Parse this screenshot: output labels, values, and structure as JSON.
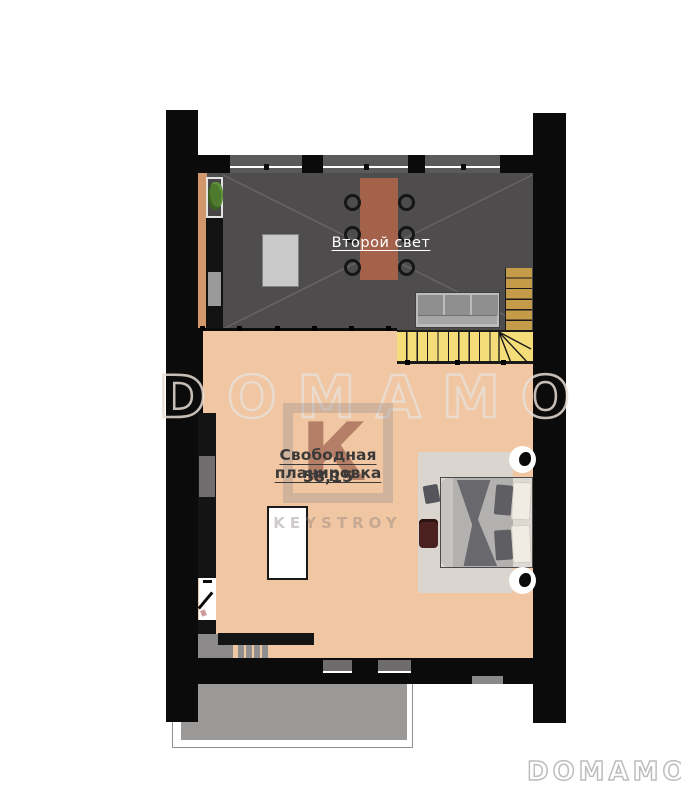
{
  "plan": {
    "upper_room_label": "Второй свет",
    "main_room_label": "Свободная планировка",
    "main_room_area": "58,15"
  },
  "watermark": {
    "center_text": "DOMAMO",
    "corner_text": "DOMAMO",
    "logo_letter": "К",
    "logo_text": "KEYSTROY"
  },
  "colors": {
    "wall": "#0b0b0b",
    "upper_room_floor": "#4e4c4d",
    "main_room_floor": "#f1c6a2",
    "stair_upper": "#c49b49",
    "stair_lower": "#f5de7a",
    "terrace": "#9b9998",
    "dining_table": "#a5624b",
    "wood_accent": "#d2986b",
    "plant": "#4d7a2c"
  }
}
